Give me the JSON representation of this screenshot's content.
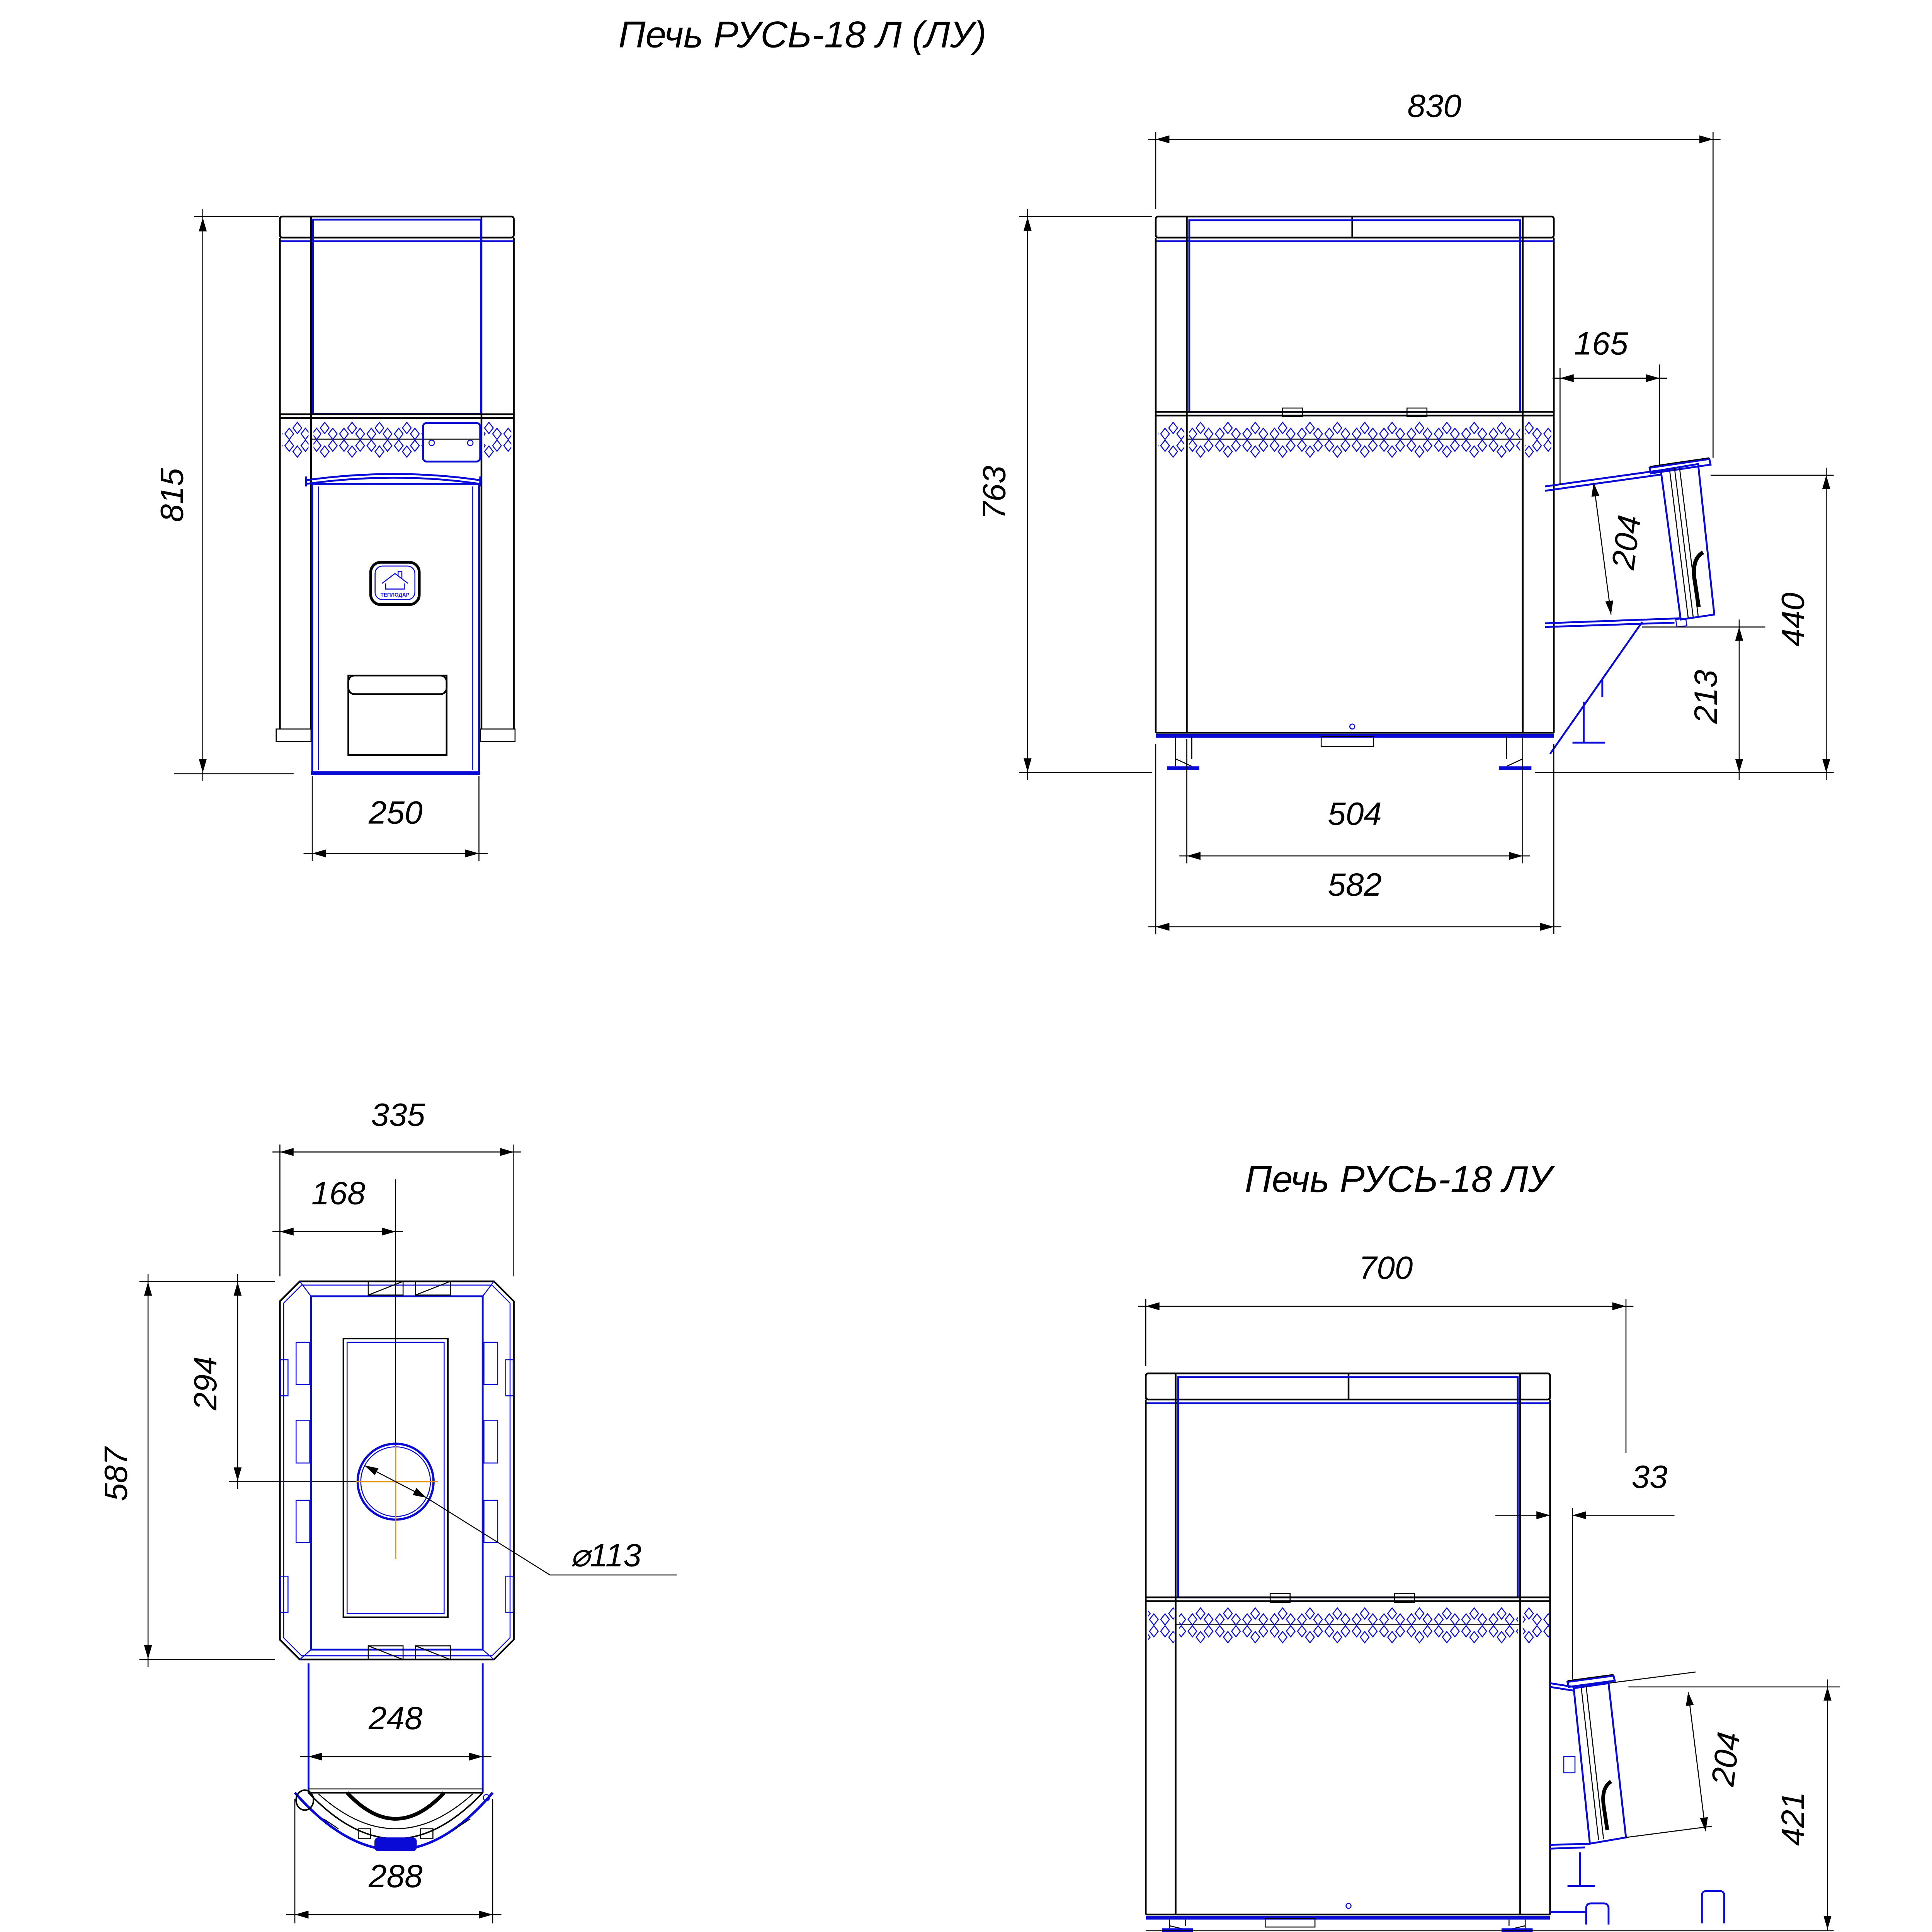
{
  "titles": {
    "main": "Печь РУСЬ-18 Л (ЛУ)",
    "variant": "Печь РУСЬ-18 ЛУ"
  },
  "logo": {
    "brand": "ТЕПЛОДАР"
  },
  "colors": {
    "line_blue": "#0a0ad6",
    "line_black": "#000000",
    "centerline_orange": "#e8920a"
  },
  "views": {
    "front": {
      "height": "815",
      "door_width": "250"
    },
    "side_long": {
      "width": "830",
      "height": "763",
      "door_offset": "165",
      "door_face": "204",
      "door_top": "440",
      "door_bottom": "213",
      "base_inner": "504",
      "base_outer": "582"
    },
    "top": {
      "width": "335",
      "flue_offset": "168",
      "depth": "587",
      "flue_center": "294",
      "flue_diameter": "⌀113",
      "door_width": "248",
      "front_width": "288"
    },
    "side_short": {
      "width": "700",
      "door_offset": "33",
      "door_face": "204",
      "door_height": "421"
    }
  }
}
